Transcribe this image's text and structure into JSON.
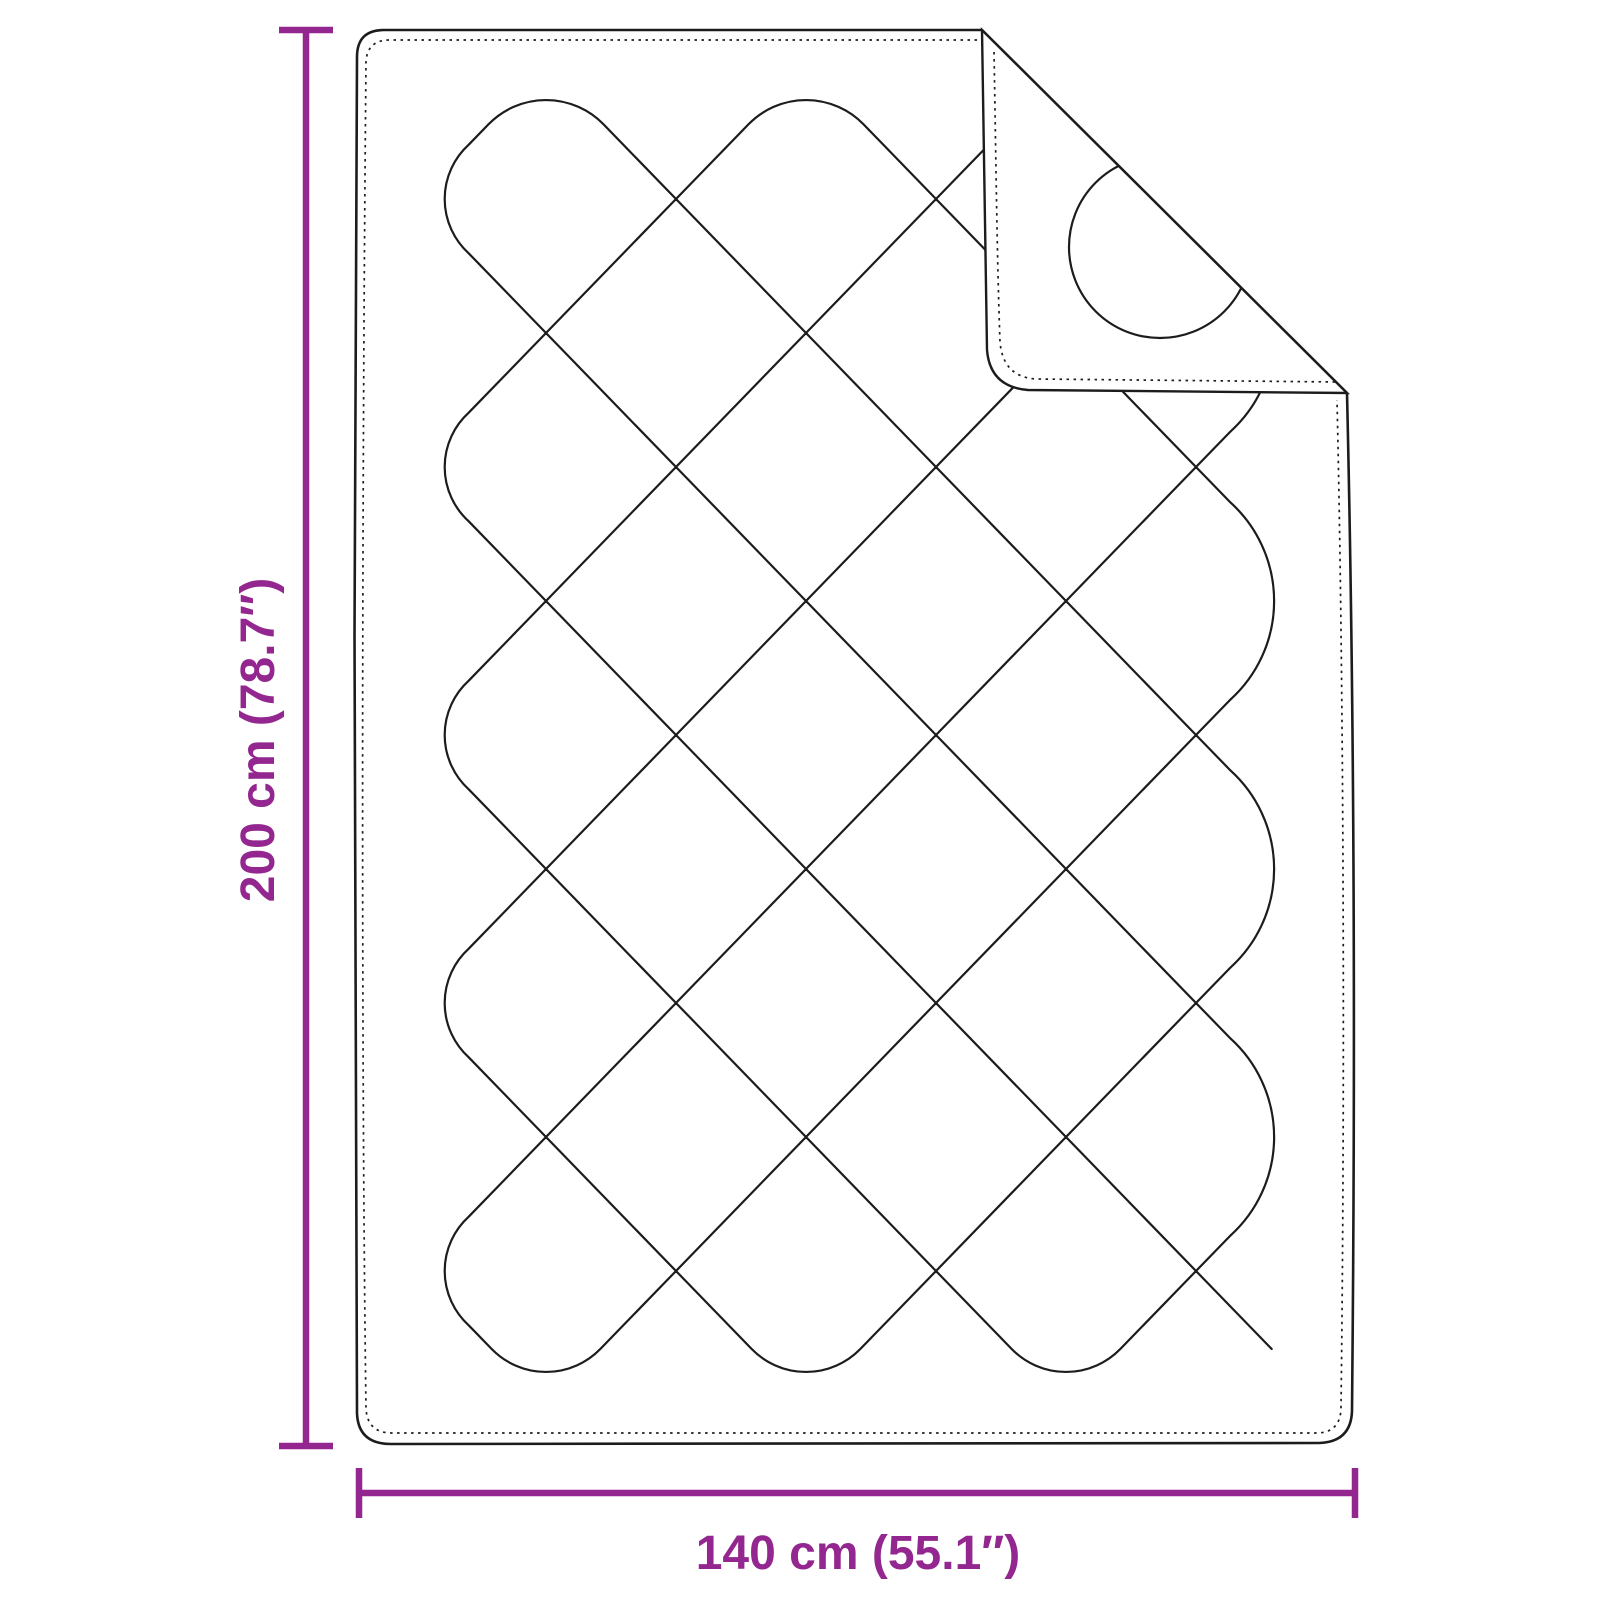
{
  "diagram": {
    "height_label": "200 cm (78.7″)",
    "width_label": "140 cm (55.1″)"
  },
  "dimensions": {
    "height_cm": 200,
    "height_in": 78.7,
    "width_cm": 140,
    "width_in": 55.1
  },
  "colors": {
    "accent": "#93278F",
    "outline": "#1c1c1c",
    "background": "#ffffff"
  }
}
